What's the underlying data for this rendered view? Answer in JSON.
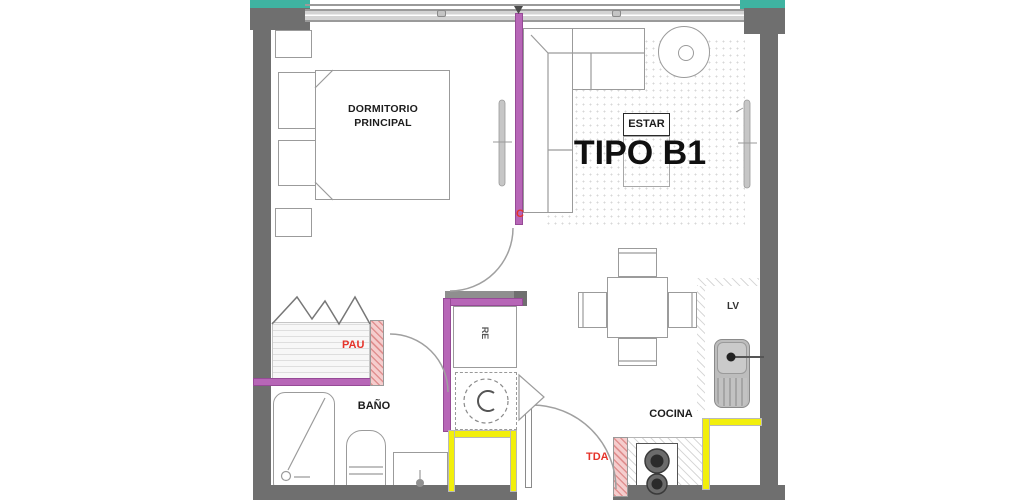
{
  "labels": {
    "title": "TIPO B1",
    "bedroom_line1": "DORMITORIO",
    "bedroom_line2": "PRINCIPAL",
    "living": "ESTAR",
    "bathroom": "BAÑO",
    "kitchen": "COCINA",
    "laundry": "LV",
    "fridge": "RE",
    "pau": "PAU",
    "tda": "TDA",
    "c_mark": "C"
  },
  "colors": {
    "wall_gray": "#6f6f6f",
    "accent_teal": "#3fb3a1",
    "partition_magenta": "#b766b7",
    "partition_pink_hatch": "#f5cdcd",
    "highlight_yellow": "#f2ef0c",
    "annotation_red": "#e5332a",
    "linework_gray": "#9b9b9b"
  }
}
